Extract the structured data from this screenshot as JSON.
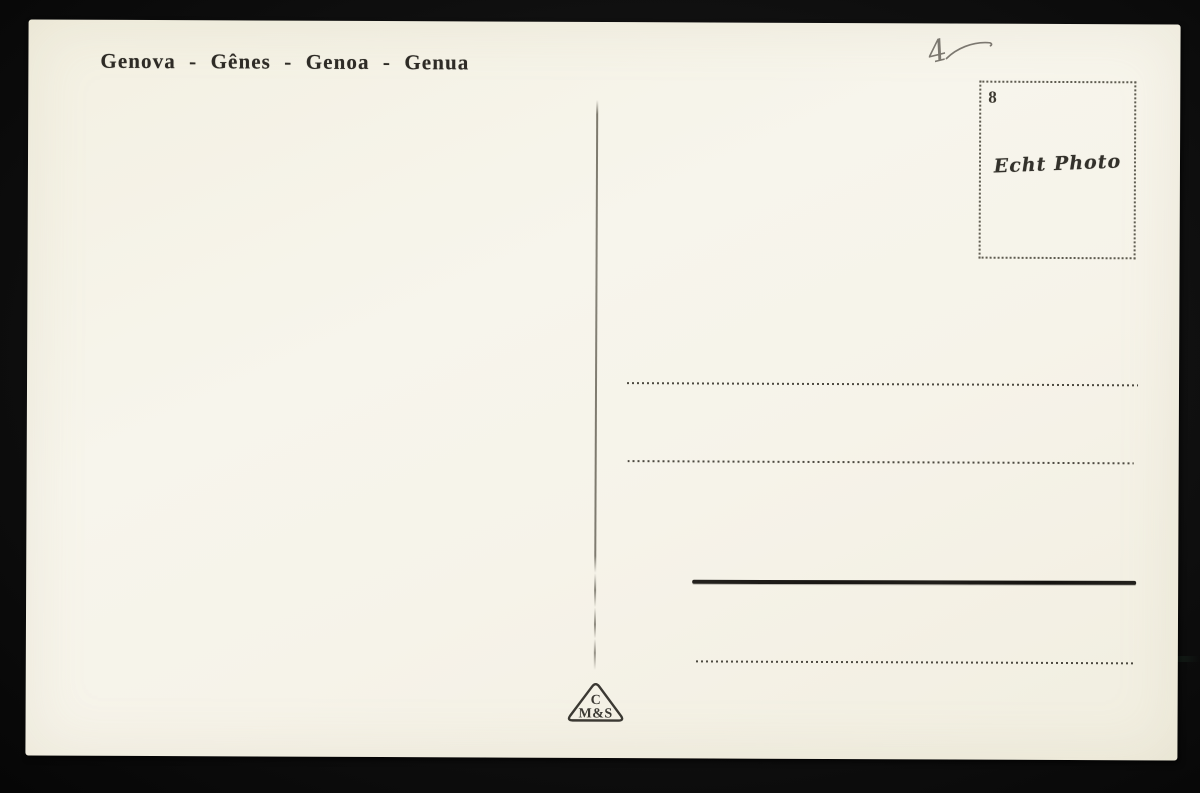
{
  "postcard": {
    "title": "Genova - Gênes - Genoa - Genua",
    "handwritten_mark": "4",
    "stamp_box": {
      "corner_number": "8",
      "brand_text": "Echt Photo"
    },
    "publisher_logo": {
      "line1": "C",
      "line2": "M&S"
    },
    "address_lines": {
      "count": 4,
      "styles": [
        "dotted",
        "dotted",
        "solid",
        "dotted"
      ]
    },
    "colors": {
      "card": "#f5f2e8",
      "backdrop": "#0e0e0e",
      "ink": "#2e2b26",
      "dotted_ink": "#3a372e",
      "pencil": "#7c7870"
    }
  }
}
